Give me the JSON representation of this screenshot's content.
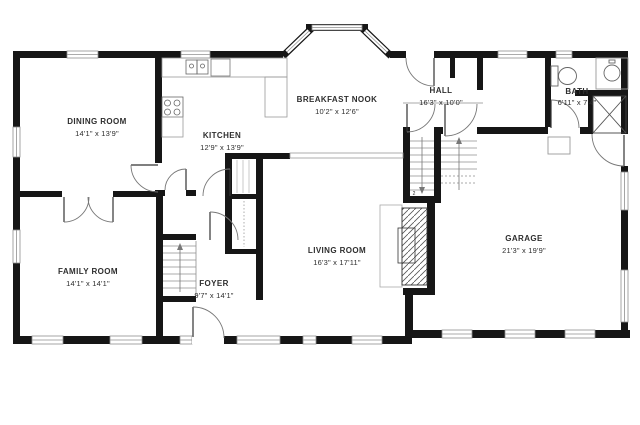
{
  "rooms": [
    {
      "name": "DINING ROOM",
      "dims": "14'1\" x 13'9\""
    },
    {
      "name": "KITCHEN",
      "dims": "12'9\" x 13'9\""
    },
    {
      "name": "BREAKFAST NOOK",
      "dims": "10'2\" x 12'6\""
    },
    {
      "name": "HALL",
      "dims": "16'3\" x 10'0\""
    },
    {
      "name": "BATH",
      "dims": "6'11\" x 7'4\""
    },
    {
      "name": "FAMILY ROOM",
      "dims": "14'1\" x 14'1\""
    },
    {
      "name": "FOYER",
      "dims": "9'7\" x 14'1\""
    },
    {
      "name": "LIVING ROOM",
      "dims": "16'3\" x 17'11\""
    },
    {
      "name": "GARAGE",
      "dims": "21'3\" x 19'9\""
    }
  ],
  "stairs": {
    "down_label": "2"
  },
  "palette": {
    "wall": "#161616",
    "thin_line": "#8f8f8f",
    "text": "#2e2e2e",
    "background": "#ffffff"
  }
}
